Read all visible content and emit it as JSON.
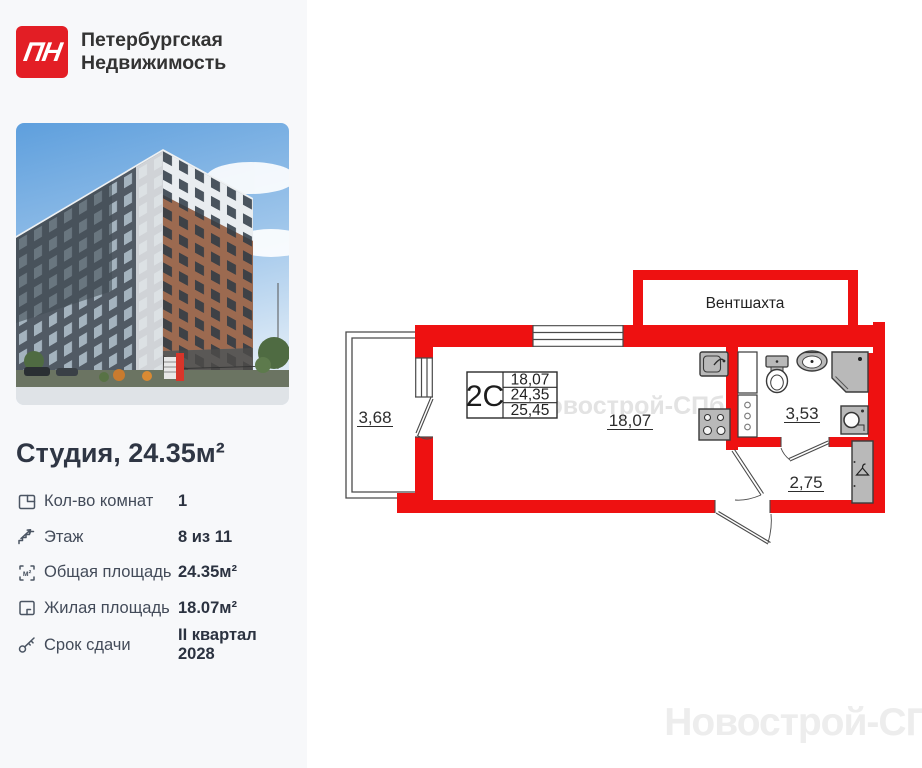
{
  "brand": {
    "logo_monogram": "ПН",
    "name_line1": "Петербургская",
    "name_line2": "Недвижимость"
  },
  "listing": {
    "title": "Студия, 24.35м²"
  },
  "specs": [
    {
      "icon": "room-count-icon",
      "label": "Кол-во комнат",
      "value": "1"
    },
    {
      "icon": "floor-icon",
      "label": "Этаж",
      "value": "8 из 11"
    },
    {
      "icon": "total-area-icon",
      "label": "Общая площадь",
      "value": "24.35м²"
    },
    {
      "icon": "living-area-icon",
      "label": "Жилая площадь",
      "value": "18.07м²"
    },
    {
      "icon": "handover-key-icon",
      "label": "Срок сдачи",
      "value": "II квартал 2028"
    }
  ],
  "floor_plan": {
    "unit_code": "2С",
    "stat_table": {
      "rows": [
        "18,07",
        "24,35",
        "25,45"
      ]
    },
    "vent_shaft_label": "Вентшахта",
    "areas": {
      "balcony": "3,68",
      "living_room": "18,07",
      "bathroom": "3,53",
      "hallway": "2,75"
    },
    "colors": {
      "wall_red": "#ee1111",
      "fixture_gray": "#b9b9b9",
      "brand_red": "#e31e25"
    }
  },
  "watermark": {
    "text": "Новострой-СПб"
  }
}
